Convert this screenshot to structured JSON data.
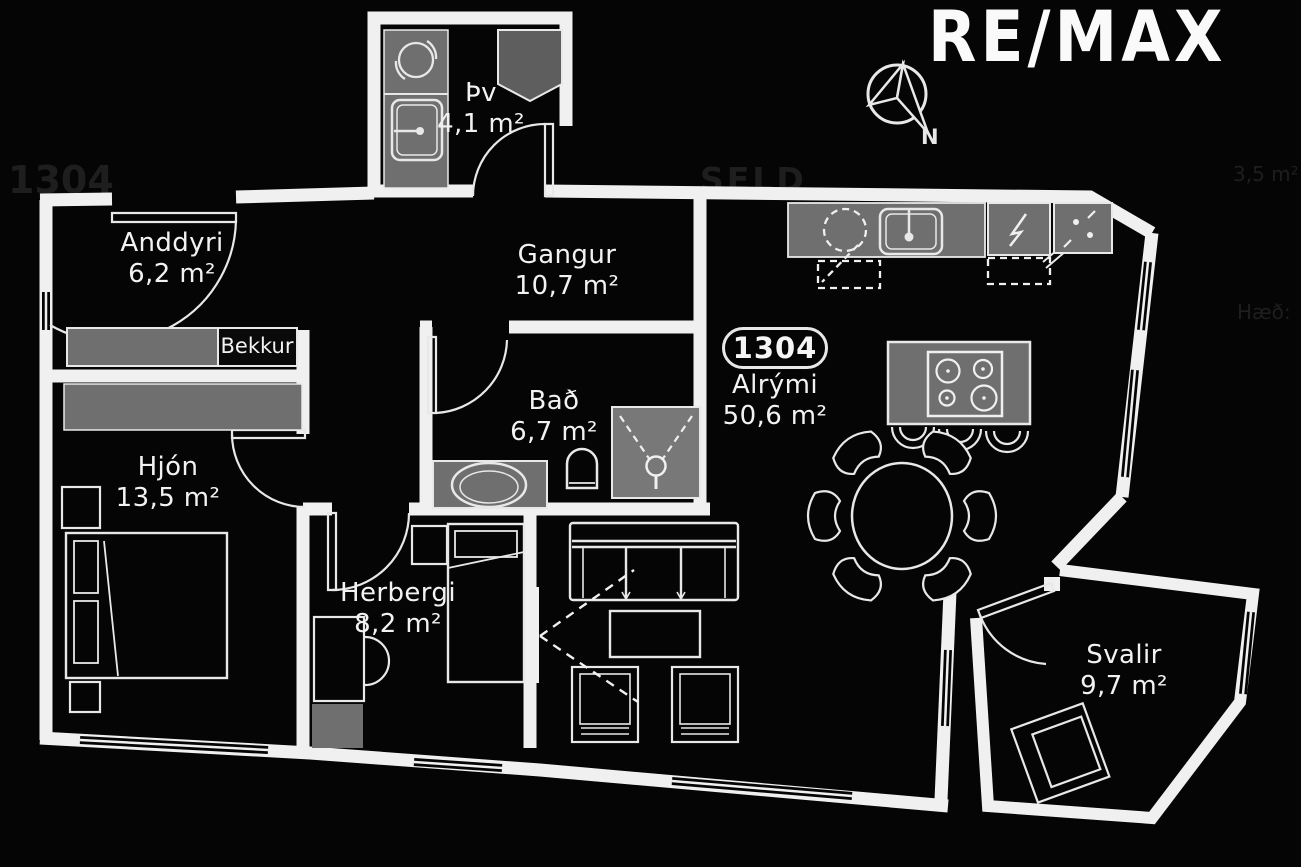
{
  "brand": {
    "logo_text": "RE/MAX"
  },
  "compass": {
    "label": "N"
  },
  "unit": {
    "badge": "1304"
  },
  "rooms": [
    {
      "id": "laundry",
      "name": "Þv",
      "area": "4,1 m²"
    },
    {
      "id": "entry",
      "name": "Anddyri",
      "area": "6,2 m²"
    },
    {
      "id": "hallway",
      "name": "Gangur",
      "area": "10,7 m²"
    },
    {
      "id": "bathroom",
      "name": "Bað",
      "area": "6,7 m²"
    },
    {
      "id": "master-bedroom",
      "name": "Hjón",
      "area": "13,5 m²"
    },
    {
      "id": "bedroom",
      "name": "Herbergi",
      "area": "8,2 m²"
    },
    {
      "id": "open-living",
      "name": "Alrými",
      "area": "50,6 m²"
    },
    {
      "id": "balcony",
      "name": "Svalir",
      "area": "9,7 m²"
    }
  ],
  "labels": {
    "bench": "Bekkur"
  },
  "ghost_text": {
    "unit": "1304",
    "status": "SELD",
    "area_small": "3,5 m²",
    "floor": "Hæð:"
  },
  "colors": {
    "background": "#050505",
    "walls": "#f0f0f0",
    "furniture_fill": "#6f6f6f",
    "furniture_outline": "#e8e8e8",
    "room_text": "#f2f2f2",
    "ghost": "#1e1e1e",
    "logo": "#fafafa"
  }
}
